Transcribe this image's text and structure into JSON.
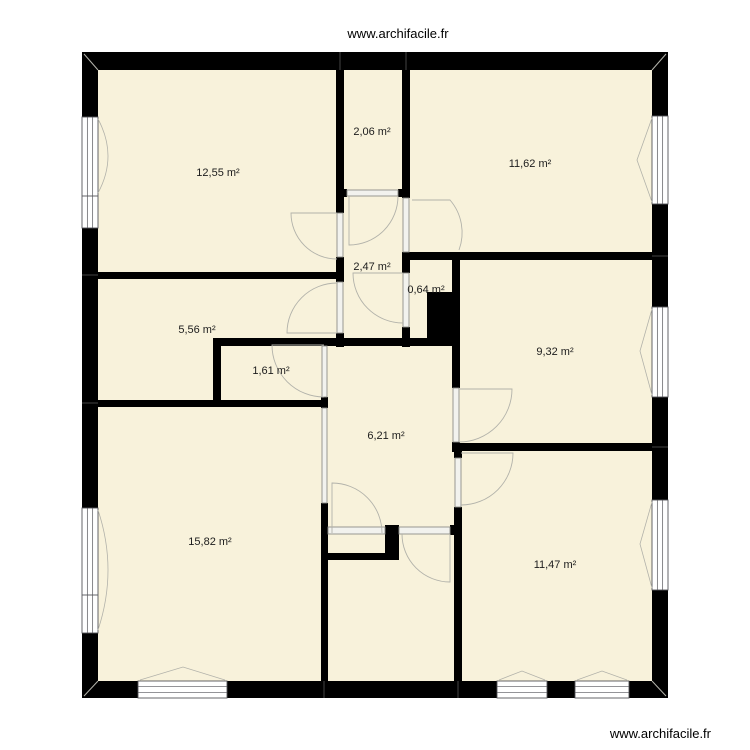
{
  "site": {
    "watermark_top": "www.archifacile.fr",
    "watermark_bottom": "www.archifacile.fr"
  },
  "colors": {
    "floor_fill": "#f8f2db",
    "wall": "#000000",
    "opening_fill": "#f2f2ee",
    "opening_stroke": "#8e8e88",
    "window_fill": "#ffffff",
    "window_stroke": "#55555a",
    "arc_stroke": "#b2b2aa",
    "junction": "#666666",
    "label": "#1c1c1c"
  },
  "rooms": [
    {
      "name": "room-12-55",
      "label": "12,55 m²",
      "area_m2": 12.55,
      "x": 218,
      "y": 176
    },
    {
      "name": "room-2-06",
      "label": "2,06 m²",
      "area_m2": 2.06,
      "x": 372,
      "y": 135
    },
    {
      "name": "room-11-62",
      "label": "11,62 m²",
      "area_m2": 11.62,
      "x": 530,
      "y": 167
    },
    {
      "name": "room-2-47",
      "label": "2,47 m²",
      "area_m2": 2.47,
      "x": 372,
      "y": 270
    },
    {
      "name": "room-0-64",
      "label": "0,64 m²",
      "area_m2": 0.64,
      "x": 426,
      "y": 293
    },
    {
      "name": "room-5-56",
      "label": "5,56 m²",
      "area_m2": 5.56,
      "x": 197,
      "y": 333
    },
    {
      "name": "room-9-32",
      "label": "9,32 m²",
      "area_m2": 9.32,
      "x": 555,
      "y": 355
    },
    {
      "name": "room-1-61",
      "label": "1,61 m²",
      "area_m2": 1.61,
      "x": 271,
      "y": 374
    },
    {
      "name": "room-6-21",
      "label": "6,21 m²",
      "area_m2": 6.21,
      "x": 386,
      "y": 439
    },
    {
      "name": "room-15-82",
      "label": "15,82 m²",
      "area_m2": 15.82,
      "x": 210,
      "y": 545
    },
    {
      "name": "room-11-47",
      "label": "11,47 m²",
      "area_m2": 11.47,
      "x": 555,
      "y": 568
    }
  ],
  "plan": {
    "floor": [
      98,
      70,
      554,
      611
    ],
    "walls": [
      [
        82,
        52,
        586,
        18
      ],
      [
        82,
        681,
        586,
        17
      ],
      [
        82,
        52,
        16,
        646
      ],
      [
        652,
        52,
        16,
        646
      ],
      [
        98,
        272,
        239,
        7
      ],
      [
        98,
        400,
        224,
        7
      ],
      [
        213,
        338,
        247,
        8
      ],
      [
        213,
        338,
        8,
        69
      ],
      [
        336,
        70,
        8,
        143
      ],
      [
        336,
        257,
        8,
        25
      ],
      [
        336,
        333,
        8,
        14
      ],
      [
        402,
        70,
        8,
        128
      ],
      [
        402,
        252,
        8,
        21
      ],
      [
        402,
        327,
        8,
        20
      ],
      [
        336,
        189,
        11,
        8
      ],
      [
        398,
        189,
        12,
        8
      ],
      [
        410,
        252,
        242,
        8
      ],
      [
        452,
        252,
        8,
        136
      ],
      [
        452,
        442,
        8,
        10
      ],
      [
        458,
        443,
        194,
        8
      ],
      [
        454,
        451,
        8,
        7
      ],
      [
        454,
        507,
        8,
        174
      ],
      [
        321,
        397,
        7,
        11
      ],
      [
        321,
        503,
        7,
        178
      ],
      [
        385,
        525,
        14,
        35
      ],
      [
        327,
        553,
        65,
        7
      ],
      [
        450,
        525,
        6,
        10
      ],
      [
        427,
        292,
        25,
        48
      ]
    ],
    "windows": [
      {
        "x": 82,
        "y": 117,
        "w": 16,
        "h": 111,
        "o": "v",
        "div": [
          196
        ]
      },
      {
        "x": 82,
        "y": 508,
        "w": 16,
        "h": 125,
        "o": "v",
        "div": [
          595
        ]
      },
      {
        "x": 652,
        "y": 116,
        "w": 16,
        "h": 88,
        "o": "v",
        "div": []
      },
      {
        "x": 652,
        "y": 307,
        "w": 16,
        "h": 90,
        "o": "v",
        "div": []
      },
      {
        "x": 652,
        "y": 500,
        "w": 16,
        "h": 90,
        "o": "v",
        "div": []
      },
      {
        "x": 138,
        "y": 681,
        "w": 89,
        "h": 17,
        "o": "h",
        "div": []
      },
      {
        "x": 497,
        "y": 681,
        "w": 50,
        "h": 17,
        "o": "h",
        "div": []
      },
      {
        "x": 575,
        "y": 681,
        "w": 54,
        "h": 17,
        "o": "h",
        "div": []
      }
    ],
    "openings": [
      [
        347,
        190,
        51,
        6
      ],
      [
        337,
        213,
        6,
        44
      ],
      [
        337,
        282,
        6,
        51
      ],
      [
        403,
        198,
        6,
        54
      ],
      [
        403,
        273,
        6,
        54
      ],
      [
        322,
        346,
        5,
        51
      ],
      [
        322,
        408,
        5,
        95
      ],
      [
        453,
        388,
        6,
        54
      ],
      [
        455,
        458,
        6,
        49
      ],
      [
        328,
        527,
        57,
        7
      ],
      [
        399,
        527,
        51,
        7
      ]
    ],
    "door_paths": [
      "M337,213 L291,213 A46,46 0 0 0 337,259",
      "M337,333 L287,333 A50,50 0 0 1 337,283",
      "M349,196 L349,245 A49,49 0 0 0 398,196",
      "M403,273 L353,273 A50,50 0 0 0 403,323",
      "M412,200 L450,200 A50,50 0 0 1 459,250",
      "M324,345 L272,345 A52,52 0 0 0 324,397",
      "M332,533 L332,483 A50,50 0 0 1 382,533",
      "M450,534 L450,582 A48,48 0 0 1 402,534",
      "M459,389 L512,389 A53,53 0 0 1 459,442",
      "M461,453 L513,453 A52,52 0 0 1 461,505"
    ],
    "window_marks": [
      "M98,119 Q118,156 98,193",
      "M98,510 Q118,570 98,630",
      "M652,118 L637,160 L652,202",
      "M652,309 L640,351 L652,395",
      "M652,502 L640,544 L652,588",
      "M140,680 L183,667 L225,680",
      "M499,680 L522,671 L545,680",
      "M577,680 L602,671 L627,680"
    ],
    "junctions": [
      [
        340,
        52,
        340,
        70
      ],
      [
        406,
        52,
        406,
        70
      ],
      [
        82,
        275,
        98,
        275
      ],
      [
        82,
        403,
        98,
        403
      ],
      [
        652,
        256,
        668,
        256
      ],
      [
        652,
        447,
        668,
        447
      ],
      [
        324,
        681,
        324,
        698
      ],
      [
        458,
        681,
        458,
        698
      ]
    ],
    "corner_lines": [
      [
        84,
        54,
        98,
        70
      ],
      [
        666,
        54,
        652,
        70
      ],
      [
        84,
        696,
        98,
        681
      ],
      [
        666,
        696,
        652,
        681
      ]
    ]
  }
}
